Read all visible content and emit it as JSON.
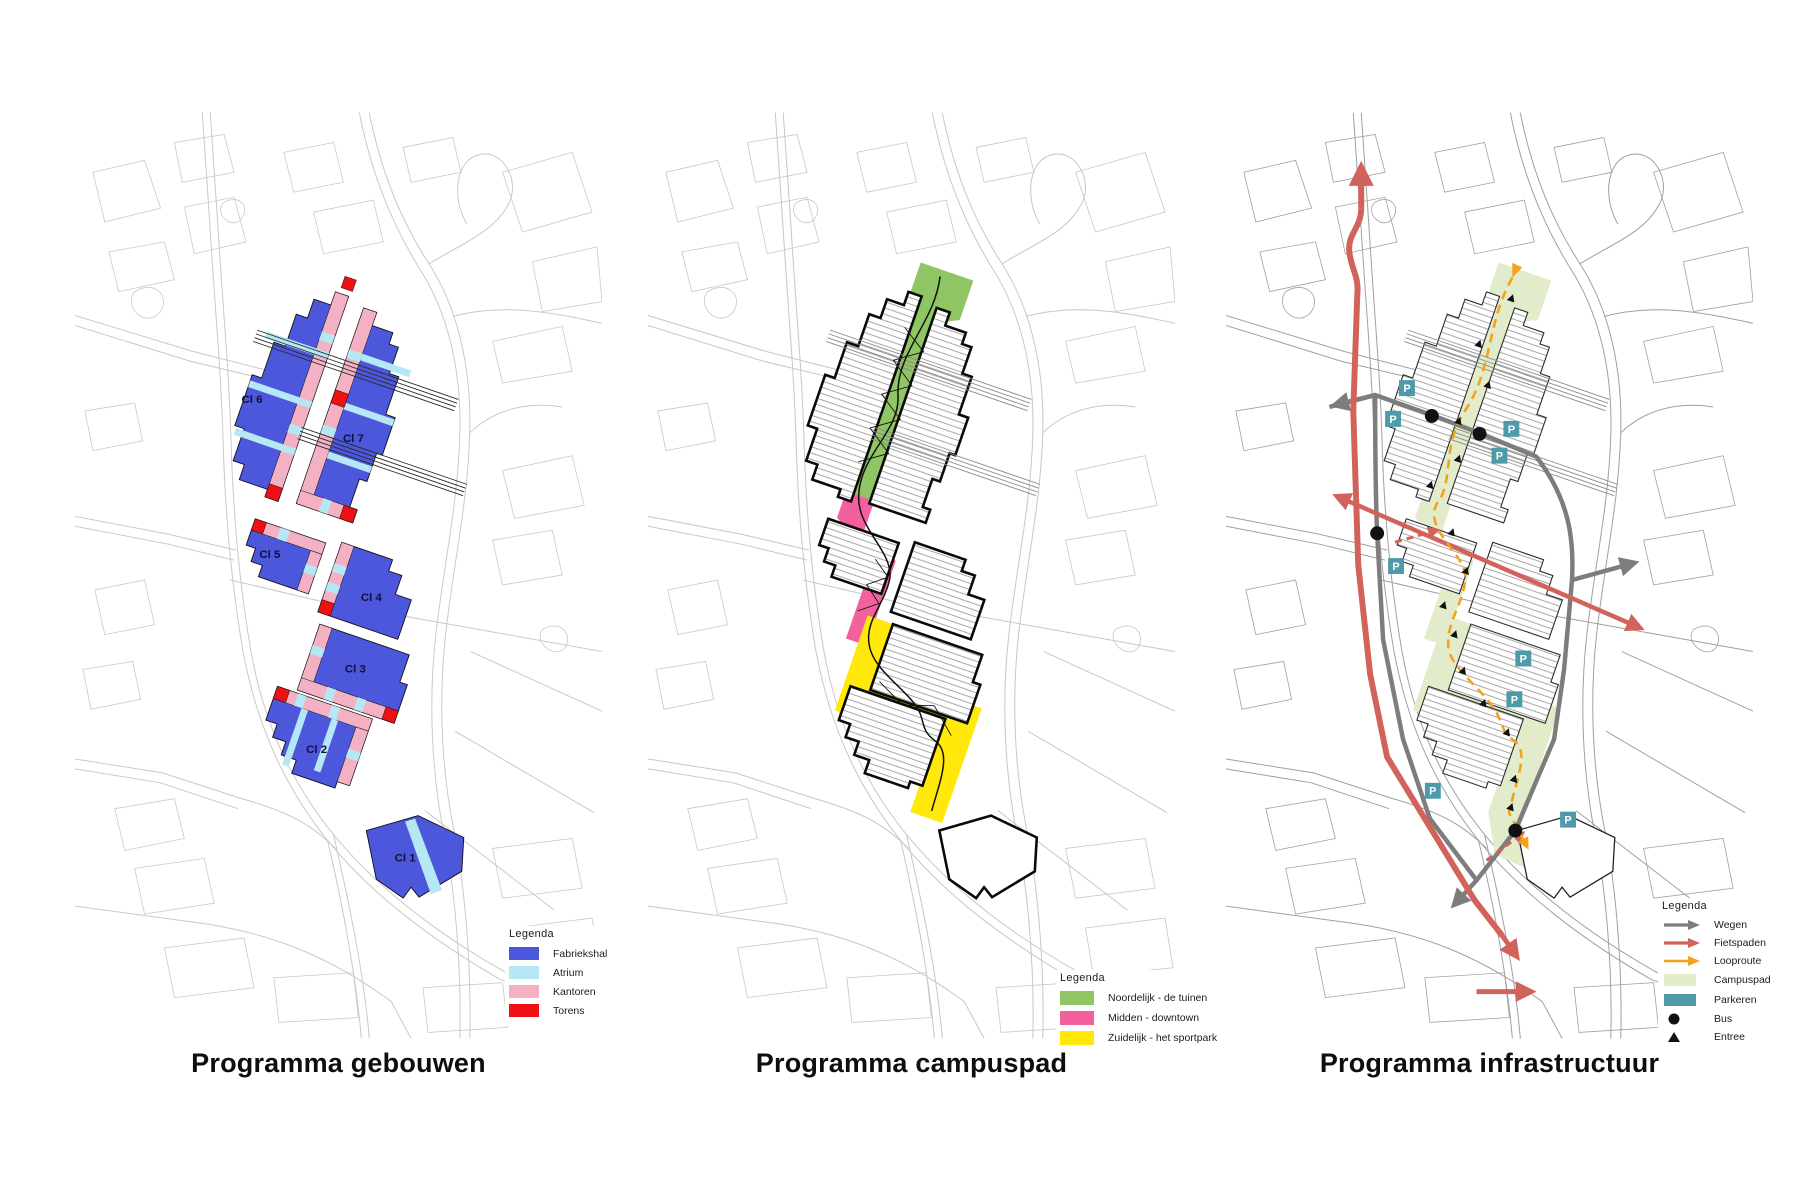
{
  "panels": [
    {
      "id": "gebouwen",
      "title": "Programma gebouwen",
      "buildings": [
        {
          "label": "Cl 1"
        },
        {
          "label": "Cl 2"
        },
        {
          "label": "Cl 3"
        },
        {
          "label": "Cl 4"
        },
        {
          "label": "Cl 5"
        },
        {
          "label": "Cl 6"
        },
        {
          "label": "Cl 7"
        }
      ],
      "legend": {
        "title": "Legenda",
        "items": [
          {
            "label": "Fabriekshal",
            "color": "#4c57dc"
          },
          {
            "label": "Atrium",
            "color": "#b5e7f5"
          },
          {
            "label": "Kantoren",
            "color": "#f5b1c4"
          },
          {
            "label": "Torens",
            "color": "#ee1013"
          }
        ]
      }
    },
    {
      "id": "campuspad",
      "title": "Programma campuspad",
      "legend": {
        "title": "Legenda",
        "items": [
          {
            "label": "Noordelijk - de tuinen",
            "color": "#8fc563"
          },
          {
            "label": "Midden - downtown",
            "color": "#f2609e"
          },
          {
            "label": "Zuidelijk - het sportpark",
            "color": "#ffe80a"
          }
        ]
      }
    },
    {
      "id": "infrastructuur",
      "title": "Programma infrastructuur",
      "marker_letter": "P",
      "legend": {
        "title": "Legenda",
        "items": [
          {
            "label": "Wegen",
            "type": "arrow",
            "color": "#7d7d7d"
          },
          {
            "label": "Fietspaden",
            "type": "arrow",
            "color": "#d2635a"
          },
          {
            "label": "Looproute",
            "type": "arrow",
            "color": "#f2a31b"
          },
          {
            "label": "Campuspad",
            "type": "swatch",
            "color": "#e2ecca"
          },
          {
            "label": "Parkeren",
            "type": "swatch",
            "color": "#4f9aa8"
          },
          {
            "label": "Bus",
            "type": "dot",
            "color": "#111111"
          },
          {
            "label": "Entree",
            "type": "triangle",
            "color": "#111111"
          }
        ]
      }
    }
  ],
  "colors": {
    "basemap_light": "#c9c9c9",
    "basemap_dark": "#a0a0a0",
    "wegen": "#7d7d7d",
    "fietspaden": "#d2635a",
    "looproute": "#f2a31b",
    "campuspad": "#e2ecca",
    "parkeren": "#4f9aa8",
    "bus": "#111111"
  }
}
